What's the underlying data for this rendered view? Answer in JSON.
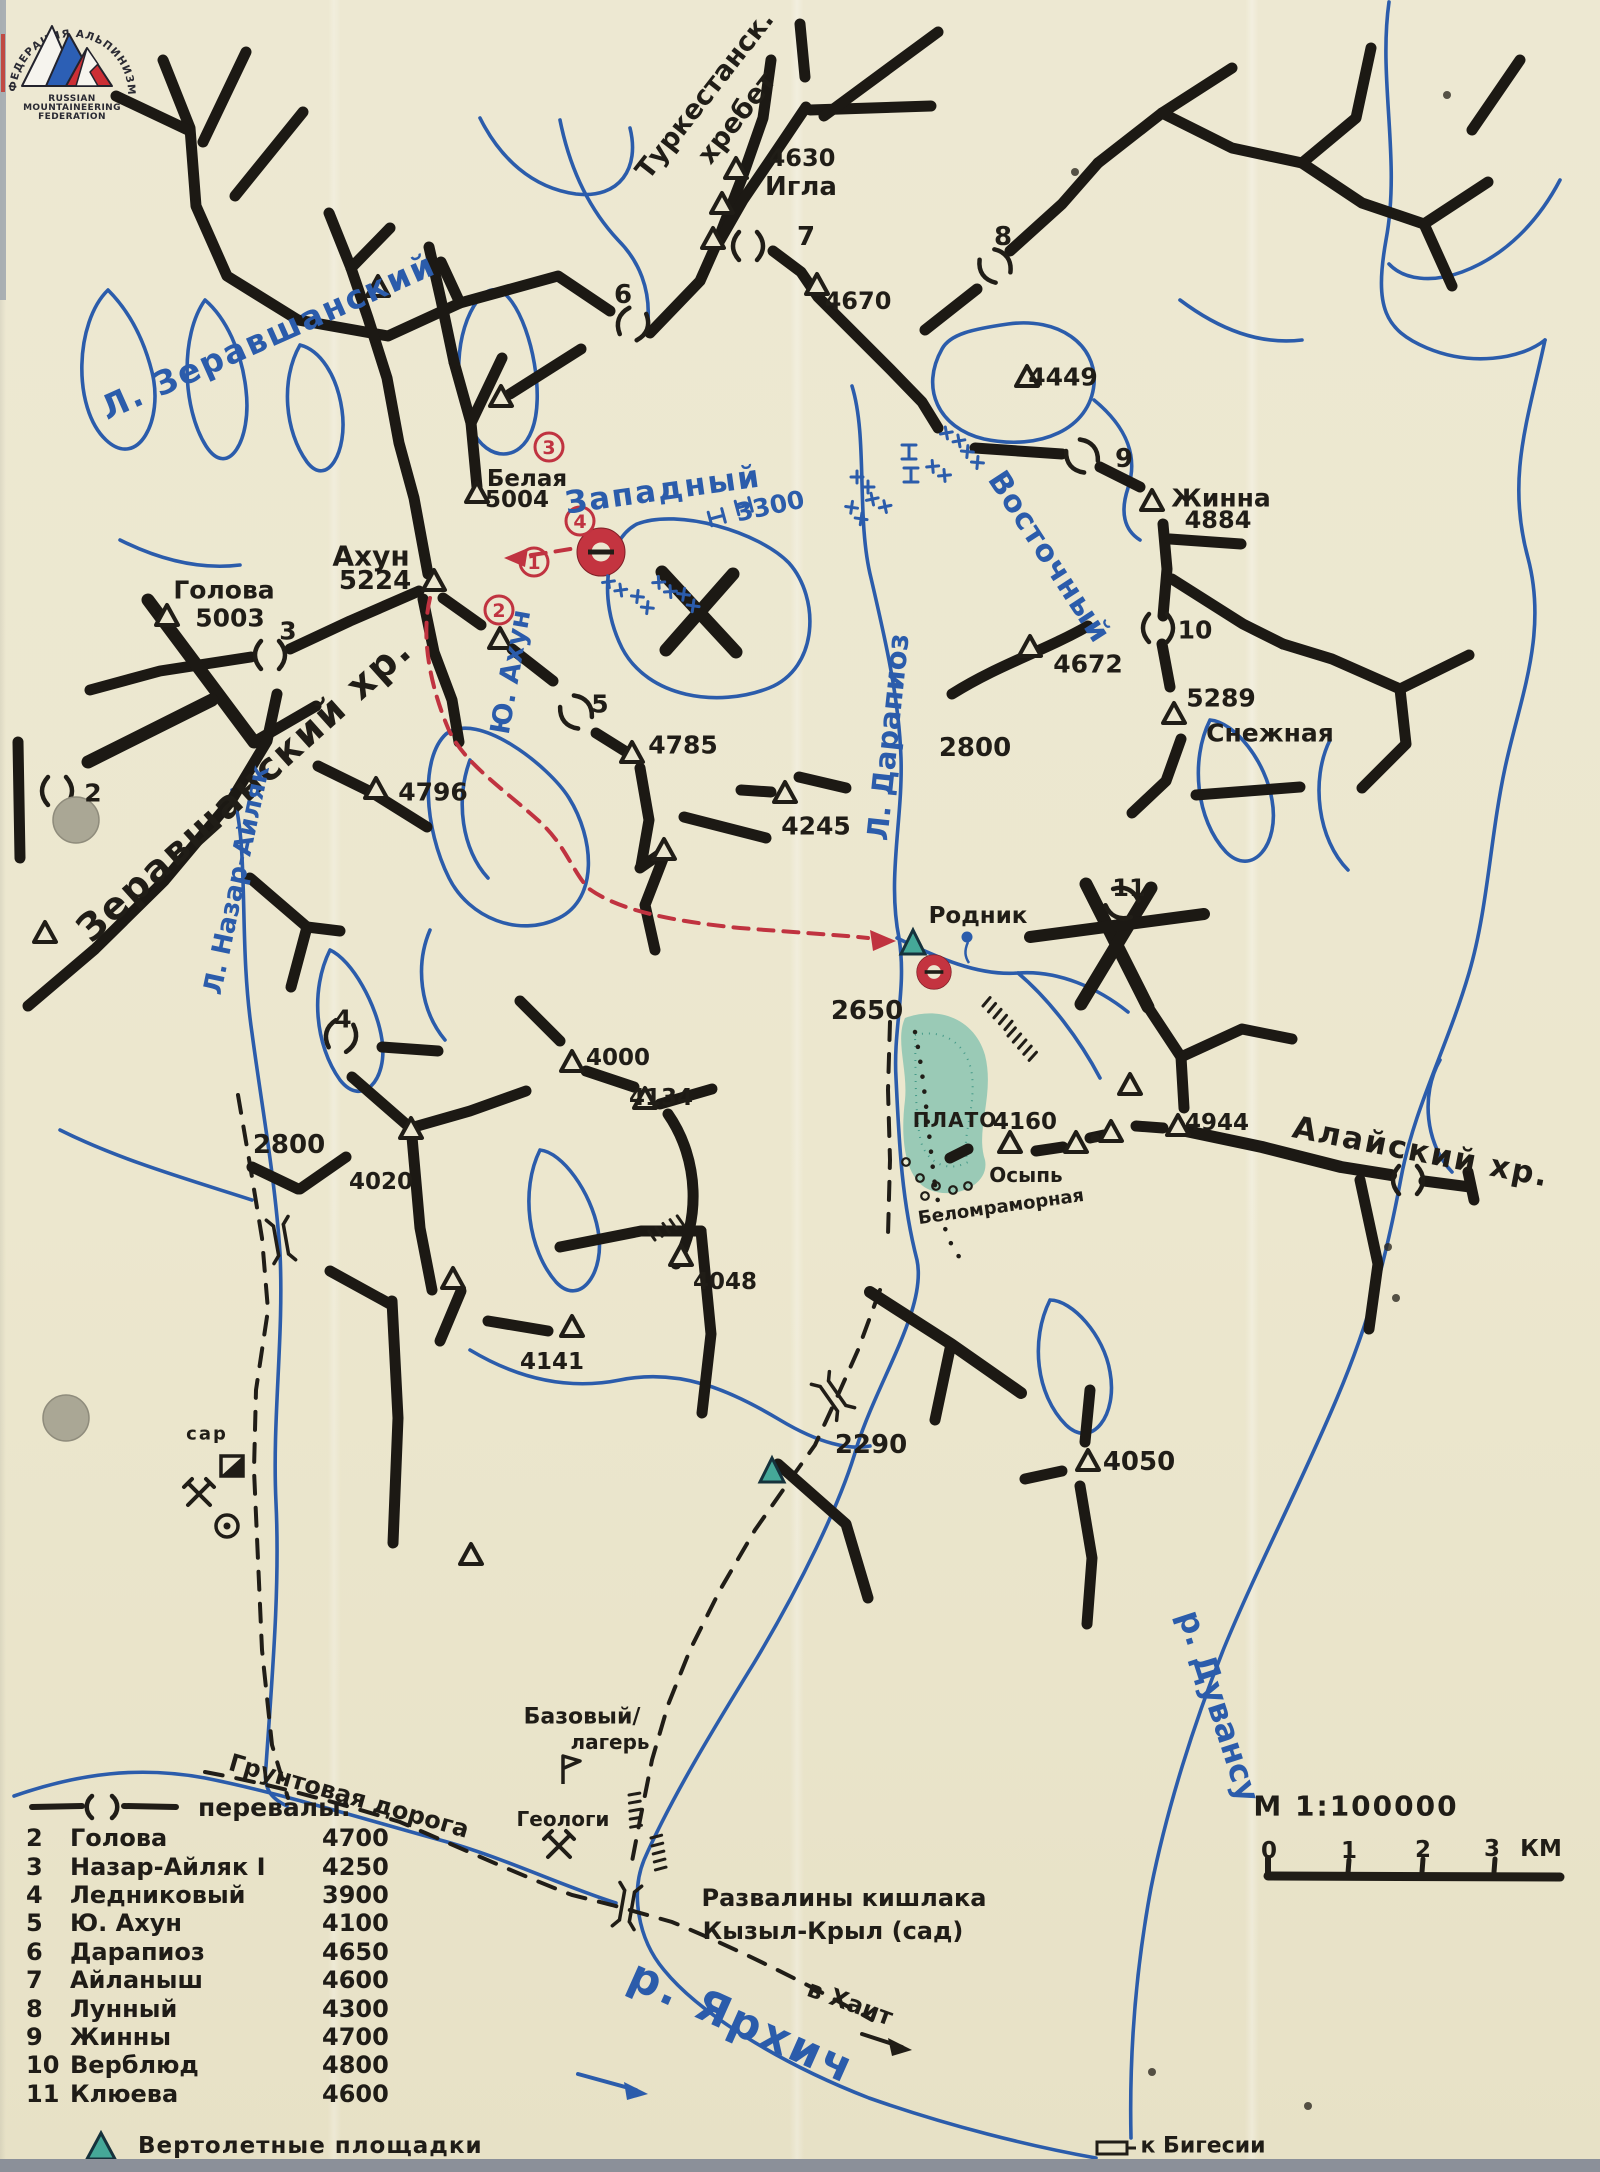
{
  "colors": {
    "ink": "#201d17",
    "blue": "#2b5cab",
    "red": "#c03340",
    "teal": "#45a898",
    "paper": "#ece7d0"
  },
  "logo": {
    "arc_text": "ФЕДЕРАЦИЯ АЛЬПИНИЗМА РОССИИ",
    "lines": [
      "RUSSIAN",
      "MOUNTAINEERING",
      "FEDERATION"
    ]
  },
  "scale": {
    "title": "М 1:100000",
    "ticks": [
      "0",
      "1",
      "2",
      "3"
    ],
    "unit": "КМ"
  },
  "legend": {
    "passes_label": "перевалы:",
    "items": [
      {
        "n": "2",
        "name": "Голова",
        "alt": "4700"
      },
      {
        "n": "3",
        "name": "Назар-Айляк I",
        "alt": "4250"
      },
      {
        "n": "4",
        "name": "Ледниковый",
        "alt": "3900"
      },
      {
        "n": "5",
        "name": "Ю. Ахун",
        "alt": "4100"
      },
      {
        "n": "6",
        "name": "Дарапиоз",
        "alt": "4650"
      },
      {
        "n": "7",
        "name": "Айланыш",
        "alt": "4600"
      },
      {
        "n": "8",
        "name": "Лунный",
        "alt": "4300"
      },
      {
        "n": "9",
        "name": "Жинны",
        "alt": "4700"
      },
      {
        "n": "10",
        "name": "Верблюд",
        "alt": "4800"
      },
      {
        "n": "11",
        "name": "Клюева",
        "alt": "4600"
      }
    ],
    "heli_label": "Вертолетные площадки"
  },
  "map": {
    "texts": [
      {
        "t": "Туркестанск.",
        "x": 705,
        "y": 95,
        "s": 27,
        "r": -52
      },
      {
        "t": "хребет",
        "x": 737,
        "y": 118,
        "s": 27,
        "r": -52
      },
      {
        "t": "4630",
        "x": 802,
        "y": 158,
        "s": 24
      },
      {
        "t": "Игла",
        "x": 801,
        "y": 187,
        "s": 26
      },
      {
        "t": "4670",
        "x": 858,
        "y": 301,
        "s": 24
      },
      {
        "t": "6",
        "x": 623,
        "y": 295,
        "s": 26
      },
      {
        "t": "7",
        "x": 806,
        "y": 237,
        "s": 26
      },
      {
        "t": "8",
        "x": 1003,
        "y": 237,
        "s": 26
      },
      {
        "t": "9",
        "x": 1124,
        "y": 459,
        "s": 26
      },
      {
        "t": "4449",
        "x": 1063,
        "y": 377,
        "s": 25
      },
      {
        "t": "Жинна",
        "x": 1221,
        "y": 498,
        "s": 25
      },
      {
        "t": "4884",
        "x": 1218,
        "y": 520,
        "s": 24
      },
      {
        "t": "Л. Зеравшанский",
        "x": 268,
        "y": 336,
        "s": 33,
        "c": "blue",
        "r": -24,
        "ls": 2
      },
      {
        "t": "Белая",
        "x": 527,
        "y": 479,
        "s": 23
      },
      {
        "t": "5004",
        "x": 517,
        "y": 500,
        "s": 23
      },
      {
        "t": "Ахун",
        "x": 371,
        "y": 556,
        "s": 28
      },
      {
        "t": "5224",
        "x": 375,
        "y": 581,
        "s": 26
      },
      {
        "t": "Голова",
        "x": 224,
        "y": 590,
        "s": 25
      },
      {
        "t": "5003",
        "x": 230,
        "y": 618,
        "s": 25
      },
      {
        "t": "3",
        "x": 288,
        "y": 631,
        "s": 25
      },
      {
        "t": "Западный",
        "x": 663,
        "y": 490,
        "s": 31,
        "c": "blue",
        "r": -8,
        "ls": 2
      },
      {
        "t": "3300",
        "x": 770,
        "y": 506,
        "s": 25,
        "c": "blue",
        "r": -12
      },
      {
        "t": "Восточный",
        "x": 1049,
        "y": 557,
        "s": 30,
        "c": "blue",
        "r": 57,
        "ls": 1
      },
      {
        "t": "Зеравшанский хр.",
        "x": 244,
        "y": 789,
        "s": 38,
        "r": -42,
        "ls": 2
      },
      {
        "t": "Л. Назар-Айляк",
        "x": 237,
        "y": 880,
        "s": 26,
        "c": "blue",
        "r": -78
      },
      {
        "t": "Ю. Ахун",
        "x": 511,
        "y": 672,
        "s": 27,
        "c": "blue",
        "r": -80
      },
      {
        "t": "Л. Дарапиоз",
        "x": 888,
        "y": 737,
        "s": 29,
        "c": "blue",
        "r": -84
      },
      {
        "t": "2800",
        "x": 975,
        "y": 748,
        "s": 26
      },
      {
        "t": "4672",
        "x": 1088,
        "y": 664,
        "s": 25
      },
      {
        "t": "10",
        "x": 1195,
        "y": 630,
        "s": 25
      },
      {
        "t": "5289",
        "x": 1221,
        "y": 698,
        "s": 25
      },
      {
        "t": "Снежная",
        "x": 1270,
        "y": 733,
        "s": 25
      },
      {
        "t": "4796",
        "x": 433,
        "y": 792,
        "s": 25
      },
      {
        "t": "5",
        "x": 600,
        "y": 704,
        "s": 25
      },
      {
        "t": "4785",
        "x": 683,
        "y": 745,
        "s": 25
      },
      {
        "t": "4245",
        "x": 816,
        "y": 826,
        "s": 25
      },
      {
        "t": "2",
        "x": 93,
        "y": 793,
        "s": 25
      },
      {
        "t": "11",
        "x": 1129,
        "y": 888,
        "s": 24
      },
      {
        "t": "Родник",
        "x": 978,
        "y": 916,
        "s": 23
      },
      {
        "t": "2650",
        "x": 867,
        "y": 1011,
        "s": 26
      },
      {
        "t": "ПЛАТО",
        "x": 955,
        "y": 1120,
        "s": 20,
        "ls": 1
      },
      {
        "t": "4160",
        "x": 1025,
        "y": 1122,
        "s": 23
      },
      {
        "t": "Осыпь",
        "x": 1026,
        "y": 1175,
        "s": 20
      },
      {
        "t": "Беломраморная",
        "x": 1001,
        "y": 1207,
        "s": 18,
        "r": -8
      },
      {
        "t": "4944",
        "x": 1217,
        "y": 1123,
        "s": 23
      },
      {
        "t": "Алайский хр.",
        "x": 1421,
        "y": 1152,
        "s": 31,
        "r": 11,
        "ls": 2
      },
      {
        "t": "4",
        "x": 343,
        "y": 1019,
        "s": 25
      },
      {
        "t": "2800",
        "x": 289,
        "y": 1145,
        "s": 26
      },
      {
        "t": "4000",
        "x": 618,
        "y": 1058,
        "s": 23
      },
      {
        "t": "4134",
        "x": 661,
        "y": 1098,
        "s": 23
      },
      {
        "t": "4020",
        "x": 381,
        "y": 1182,
        "s": 23
      },
      {
        "t": "4048",
        "x": 725,
        "y": 1282,
        "s": 23
      },
      {
        "t": "4141",
        "x": 552,
        "y": 1362,
        "s": 23
      },
      {
        "t": "2290",
        "x": 871,
        "y": 1445,
        "s": 26
      },
      {
        "t": "4050",
        "x": 1139,
        "y": 1462,
        "s": 26
      },
      {
        "t": "сар",
        "x": 207,
        "y": 1434,
        "s": 18,
        "ls": 2
      },
      {
        "t": "р. Дувансу",
        "x": 1219,
        "y": 1706,
        "s": 32,
        "c": "blue",
        "r": 72
      },
      {
        "t": "Базовый/",
        "x": 582,
        "y": 1717,
        "s": 22
      },
      {
        "t": "лагерь",
        "x": 610,
        "y": 1742,
        "s": 20
      },
      {
        "t": "Геологи",
        "x": 563,
        "y": 1819,
        "s": 20
      },
      {
        "t": "Грунтовая дорога",
        "x": 349,
        "y": 1796,
        "s": 24,
        "r": 16
      },
      {
        "t": "Развалины кишлака",
        "x": 844,
        "y": 1898,
        "s": 24
      },
      {
        "t": "Кызыл-Крыл (сад)",
        "x": 833,
        "y": 1931,
        "s": 24
      },
      {
        "t": "в Хаит",
        "x": 850,
        "y": 2003,
        "s": 24,
        "r": 20
      },
      {
        "t": "р. Ярхич",
        "x": 742,
        "y": 2022,
        "s": 44,
        "c": "blue",
        "r": 24,
        "ls": 3
      },
      {
        "t": "к Бигесии",
        "x": 1203,
        "y": 2146,
        "s": 22
      },
      {
        "t": "М 1:100000",
        "x": 1356,
        "y": 1806,
        "s": 28,
        "ls": 2
      },
      {
        "t": "0",
        "x": 1269,
        "y": 1851,
        "s": 23
      },
      {
        "t": "1",
        "x": 1349,
        "y": 1851,
        "s": 23
      },
      {
        "t": "2",
        "x": 1423,
        "y": 1850,
        "s": 23
      },
      {
        "t": "3",
        "x": 1492,
        "y": 1849,
        "s": 23
      },
      {
        "t": "КМ",
        "x": 1541,
        "y": 1849,
        "s": 23
      }
    ],
    "symbols": [
      {
        "k": "peak",
        "x": 736,
        "y": 170
      },
      {
        "k": "peak",
        "x": 722,
        "y": 205
      },
      {
        "k": "peak",
        "x": 713,
        "y": 240
      },
      {
        "k": "peak",
        "x": 817,
        "y": 286
      },
      {
        "k": "peak",
        "x": 378,
        "y": 288
      },
      {
        "k": "peak",
        "x": 501,
        "y": 398
      },
      {
        "k": "peak",
        "x": 477,
        "y": 494
      },
      {
        "k": "peak",
        "x": 434,
        "y": 582
      },
      {
        "k": "peak",
        "x": 500,
        "y": 640
      },
      {
        "k": "peak",
        "x": 167,
        "y": 617
      },
      {
        "k": "peak",
        "x": 45,
        "y": 934
      },
      {
        "k": "peak",
        "x": 376,
        "y": 790
      },
      {
        "k": "peak",
        "x": 632,
        "y": 754
      },
      {
        "k": "peak",
        "x": 785,
        "y": 794
      },
      {
        "k": "peak",
        "x": 664,
        "y": 851
      },
      {
        "k": "peak",
        "x": 1030,
        "y": 648
      },
      {
        "k": "peak",
        "x": 1152,
        "y": 502
      },
      {
        "k": "peak",
        "x": 1174,
        "y": 715
      },
      {
        "k": "peak",
        "x": 1027,
        "y": 378
      },
      {
        "k": "peak",
        "x": 572,
        "y": 1063
      },
      {
        "k": "peak",
        "x": 645,
        "y": 1100
      },
      {
        "k": "peak",
        "x": 411,
        "y": 1130
      },
      {
        "k": "peak",
        "x": 453,
        "y": 1280
      },
      {
        "k": "peak",
        "x": 681,
        "y": 1257
      },
      {
        "k": "peak",
        "x": 572,
        "y": 1328
      },
      {
        "k": "peak",
        "x": 471,
        "y": 1556
      },
      {
        "k": "peak",
        "x": 1088,
        "y": 1462
      },
      {
        "k": "peak",
        "x": 1178,
        "y": 1127
      },
      {
        "k": "peak",
        "x": 1076,
        "y": 1144
      },
      {
        "k": "peak",
        "x": 1111,
        "y": 1133
      },
      {
        "k": "peak",
        "x": 1130,
        "y": 1086
      },
      {
        "k": "peak",
        "x": 1010,
        "y": 1144
      },
      {
        "k": "pass",
        "x": 633,
        "y": 324,
        "r": 20
      },
      {
        "k": "pass",
        "x": 748,
        "y": 246
      },
      {
        "k": "pass",
        "x": 995,
        "y": 266,
        "r": -35
      },
      {
        "k": "pass",
        "x": 1082,
        "y": 456,
        "r": -40
      },
      {
        "k": "pass",
        "x": 1158,
        "y": 628
      },
      {
        "k": "pass",
        "x": 270,
        "y": 655
      },
      {
        "k": "pass",
        "x": 57,
        "y": 791
      },
      {
        "k": "pass",
        "x": 341,
        "y": 1036,
        "r": 15
      },
      {
        "k": "pass",
        "x": 576,
        "y": 712,
        "r": -40
      },
      {
        "k": "pass",
        "x": 1408,
        "y": 1180
      },
      {
        "k": "pass",
        "x": 1122,
        "y": 903,
        "r": -65
      },
      {
        "k": "heli",
        "x": 913,
        "y": 944
      },
      {
        "k": "heli",
        "x": 772,
        "y": 1472
      },
      {
        "k": "donut",
        "x": 601,
        "y": 552,
        "sc": 1
      },
      {
        "k": "donut",
        "x": 934,
        "y": 972,
        "sc": 0.72
      },
      {
        "k": "bridge",
        "x": 281,
        "y": 1240,
        "r": 80
      },
      {
        "k": "bridge",
        "x": 833,
        "y": 1396,
        "r": 55
      },
      {
        "k": "bridge",
        "x": 627,
        "y": 1906,
        "r": 100
      },
      {
        "k": "hut",
        "x": 232,
        "y": 1466
      },
      {
        "k": "hammers",
        "x": 199,
        "y": 1494
      },
      {
        "k": "hammers",
        "x": 559,
        "y": 1846
      },
      {
        "k": "cdot",
        "x": 227,
        "y": 1526
      },
      {
        "k": "flag",
        "x": 563,
        "y": 1768
      },
      {
        "k": "rect",
        "x": 1112,
        "y": 2148
      },
      {
        "k": "spring",
        "x": 967,
        "y": 937
      },
      {
        "k": "crev",
        "x": 952,
        "y": 436,
        "r": -10
      },
      {
        "k": "crev",
        "x": 972,
        "y": 456,
        "r": 5
      },
      {
        "k": "crev",
        "x": 938,
        "y": 470,
        "r": -5
      },
      {
        "k": "crev",
        "x": 862,
        "y": 481
      },
      {
        "k": "crev",
        "x": 878,
        "y": 502,
        "r": -12
      },
      {
        "k": "crev",
        "x": 856,
        "y": 512,
        "r": 8
      },
      {
        "k": "crev",
        "x": 614,
        "y": 585,
        "r": -8
      },
      {
        "k": "crev",
        "x": 642,
        "y": 601,
        "r": 6
      },
      {
        "k": "crev",
        "x": 664,
        "y": 586,
        "r": -4
      },
      {
        "k": "crev",
        "x": 688,
        "y": 599,
        "r": 8
      },
      {
        "k": "gate",
        "x": 909,
        "y": 445,
        "r": 90
      },
      {
        "k": "gate",
        "x": 911,
        "y": 468,
        "r": 90
      },
      {
        "k": "gate",
        "x": 737,
        "y": 508,
        "r": -15
      },
      {
        "k": "gate",
        "x": 710,
        "y": 519,
        "r": -15
      },
      {
        "k": "hach",
        "x": 655,
        "y": 1240,
        "r": -35
      },
      {
        "k": "hach",
        "x": 629,
        "y": 1795,
        "r": 80
      },
      {
        "k": "hach",
        "x": 651,
        "y": 1838,
        "r": 75
      },
      {
        "k": "hach",
        "x": 983,
        "y": 1006,
        "r": 40
      },
      {
        "k": "hach",
        "x": 1008,
        "y": 1036,
        "r": 42
      },
      {
        "k": "hole",
        "x": 76,
        "y": 820
      },
      {
        "k": "hole",
        "x": 66,
        "y": 1418
      },
      {
        "k": "speck",
        "x": 1075,
        "y": 172
      },
      {
        "k": "speck",
        "x": 1388,
        "y": 1247
      },
      {
        "k": "speck",
        "x": 1396,
        "y": 1298
      },
      {
        "k": "speck",
        "x": 1308,
        "y": 2106
      },
      {
        "k": "speck",
        "x": 1152,
        "y": 2072
      },
      {
        "k": "speck",
        "x": 1447,
        "y": 95
      },
      {
        "k": "dot",
        "x": 906,
        "y": 1162
      },
      {
        "k": "dot",
        "x": 920,
        "y": 1178
      },
      {
        "k": "dot",
        "x": 936,
        "y": 1186
      },
      {
        "k": "dot",
        "x": 953,
        "y": 1190
      },
      {
        "k": "dot",
        "x": 968,
        "y": 1186
      },
      {
        "k": "dot",
        "x": 925,
        "y": 1196
      },
      {
        "k": "bdot",
        "x": 1095,
        "y": 1138
      }
    ],
    "route_points": [
      {
        "n": "1",
        "x": 534,
        "y": 562
      },
      {
        "n": "2",
        "x": 499,
        "y": 610
      },
      {
        "n": "3",
        "x": 549,
        "y": 447
      },
      {
        "n": "4",
        "x": 580,
        "y": 521
      }
    ]
  }
}
